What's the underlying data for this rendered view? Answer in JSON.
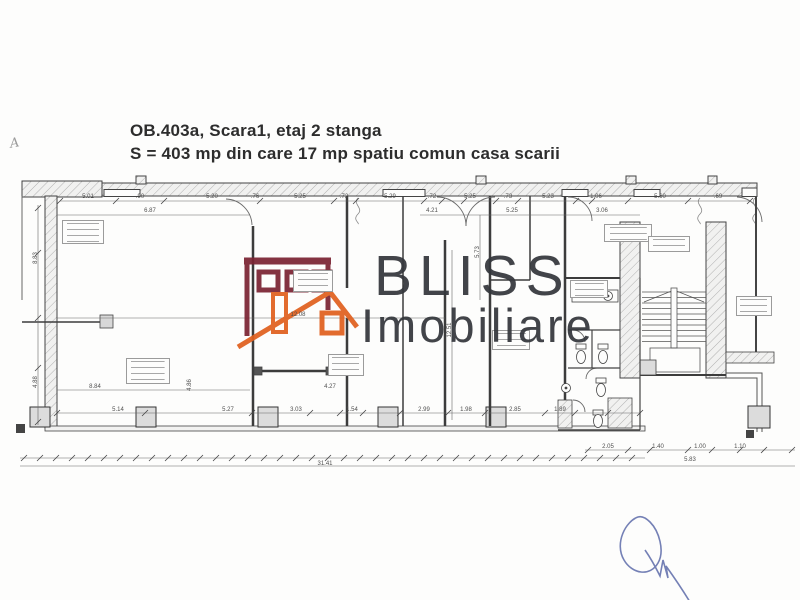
{
  "title": {
    "line1": "OB.403a, Scara1, etaj 2 stanga",
    "line2": "S = 403 mp din care 17 mp spatiu comun casa scarii"
  },
  "corner_mark": "A",
  "watermark": {
    "brand_line1": "BLISS",
    "brand_line2": "Imobiliare"
  },
  "colors": {
    "logo_building": "#7b2433",
    "logo_roof": "#e0611f",
    "brand_text": "#34373c",
    "plan_line": "#4a4a4a",
    "signature": "#6673ae"
  },
  "plan": {
    "dimensions": [
      {
        "t": "5.01",
        "x": 88,
        "y": 197
      },
      {
        "t": ".90",
        "x": 140,
        "y": 197
      },
      {
        "t": "5.20",
        "x": 212,
        "y": 197
      },
      {
        "t": ".76",
        "x": 255,
        "y": 197
      },
      {
        "t": "5.25",
        "x": 300,
        "y": 197
      },
      {
        "t": ".72",
        "x": 344,
        "y": 197
      },
      {
        "t": "5.29",
        "x": 390,
        "y": 197
      },
      {
        "t": ".72",
        "x": 432,
        "y": 197
      },
      {
        "t": "5.25",
        "x": 470,
        "y": 197
      },
      {
        "t": ".73",
        "x": 508,
        "y": 197
      },
      {
        "t": "5.23",
        "x": 548,
        "y": 197
      },
      {
        "t": "1.06",
        "x": 596,
        "y": 197
      },
      {
        "t": "5.60",
        "x": 660,
        "y": 197
      },
      {
        "t": ".69",
        "x": 718,
        "y": 197
      },
      {
        "t": "6.87",
        "x": 150,
        "y": 211
      },
      {
        "t": "4.21",
        "x": 432,
        "y": 211
      },
      {
        "t": "5.25",
        "x": 512,
        "y": 211
      },
      {
        "t": "3.06",
        "x": 602,
        "y": 211
      },
      {
        "t": "8.83",
        "x": 36,
        "y": 258,
        "r": 1
      },
      {
        "t": "4.88",
        "x": 36,
        "y": 382,
        "r": 1
      },
      {
        "t": "5.73",
        "x": 478,
        "y": 252,
        "r": 1
      },
      {
        "t": "12.51",
        "x": 450,
        "y": 330,
        "r": 1
      },
      {
        "t": "4.86",
        "x": 190,
        "y": 385,
        "r": 1
      },
      {
        "t": "12.08",
        "x": 298,
        "y": 315
      },
      {
        "t": "8.84",
        "x": 95,
        "y": 387
      },
      {
        "t": "4.27",
        "x": 330,
        "y": 387
      },
      {
        "t": "5.14",
        "x": 118,
        "y": 410
      },
      {
        "t": "5.27",
        "x": 228,
        "y": 410
      },
      {
        "t": "3.03",
        "x": 296,
        "y": 410
      },
      {
        "t": "1.54",
        "x": 352,
        "y": 410
      },
      {
        "t": "2.99",
        "x": 424,
        "y": 410
      },
      {
        "t": "1.98",
        "x": 466,
        "y": 410
      },
      {
        "t": "2.85",
        "x": 515,
        "y": 410
      },
      {
        "t": "1.89",
        "x": 560,
        "y": 410
      },
      {
        "t": "31.41",
        "x": 325,
        "y": 464
      },
      {
        "t": "2.05",
        "x": 608,
        "y": 447
      },
      {
        "t": "1.40",
        "x": 658,
        "y": 447
      },
      {
        "t": "1.00",
        "x": 700,
        "y": 447
      },
      {
        "t": "1.10",
        "x": 740,
        "y": 447
      },
      {
        "t": "5.83",
        "x": 690,
        "y": 460
      }
    ]
  }
}
